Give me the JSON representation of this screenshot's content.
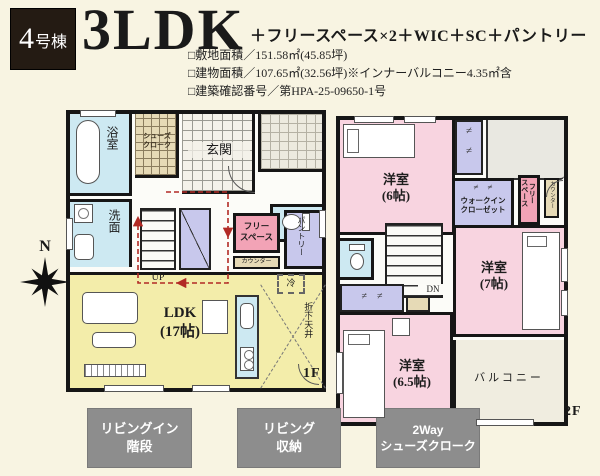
{
  "header": {
    "badge_num": "4",
    "badge_suffix": "号棟",
    "title": "3LDK",
    "subtitle": "＋フリースペース×2＋WIC＋SC＋パントリー",
    "details": [
      "□敷地面積／151.58㎡(45.85坪)",
      "□建物面積／107.65㎡(32.56坪)※インナーバルコニー4.35㎡含",
      "□建築確認番号／第HPA-25-09650-1号"
    ]
  },
  "compass": {
    "north": "N"
  },
  "floor1": {
    "floor_label": "1F",
    "rooms": {
      "bath": "浴室",
      "shoes": "シューズ\nクローク",
      "entrance": "玄関",
      "wash": "洗面",
      "stairs_up": "UP",
      "free_space": "フリー\nスペース",
      "counter": "カウンター",
      "pantry": "パントリー",
      "ldk": "LDK\n(17帖)",
      "fridge": "冷",
      "dropped_ceiling": "折下天井"
    }
  },
  "floor2": {
    "floor_label": "2F",
    "rooms": {
      "room6": "洋室\n(6帖)",
      "closet_marks": "≠\n≠",
      "wic_marks": "≠　≠",
      "wic": "ウォークイン\nクローゼット",
      "free_space": "フリー\nスペース",
      "counter": "カウンター",
      "stairs_dn": "DN",
      "room7": "洋室\n(7帖)",
      "room65": "洋室\n(6.5帖)",
      "closet65_marks": "≠　≠",
      "balcony": "バルコニー"
    }
  },
  "badges": [
    {
      "text": "リビングイン\n階段"
    },
    {
      "text": "リビング\n収納"
    },
    {
      "text": "2Way\nシューズクローク"
    }
  ],
  "colors": {
    "background": "#f8f4e2",
    "wall": "#161616",
    "room_pink": "#f8d4e0",
    "free_space_salmon": "#f2a3b6",
    "ldk_yellow": "#f3edaa",
    "wet_blue": "#cde9f2",
    "closet_lavender": "#c8c8ec",
    "counter_beige": "#e6dab6",
    "flow_line_red": "#b22a25",
    "header_badge_dark": "#241b13",
    "bottom_badge_gray": "#8d8d8d"
  }
}
